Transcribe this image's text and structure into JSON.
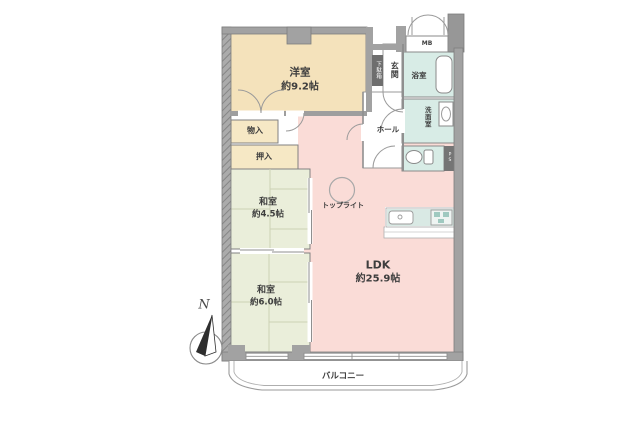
{
  "floor_plan": {
    "compass_label": "N",
    "rooms": {
      "western_room": {
        "name": "洋室",
        "area": "約9.2帖"
      },
      "japanese_room_small": {
        "name": "和室",
        "area": "約4.5帖"
      },
      "japanese_room_large": {
        "name": "和室",
        "area": "約6.0帖"
      },
      "ldk": {
        "name": "LDK",
        "area": "約25.9帖"
      }
    },
    "labels": {
      "entrance": "玄関",
      "shoe_cabinet": "下駄箱",
      "bathroom": "浴室",
      "washroom": "洗面室",
      "hall": "ホール",
      "storage": "物入",
      "closet": "押入",
      "skylight": "トップライト",
      "balcony": "バルコニー",
      "meter_box": "MB",
      "pipe_space": "PS"
    },
    "colors": {
      "western_room_fill": "#f4e2bb",
      "japanese_room_fill": "#eaeeda",
      "ldk_fill": "#fadcd7",
      "wet_area_fill": "#d8ece6",
      "storage_fill": "#f6e8c5",
      "wall": "#a2a2a2"
    }
  }
}
